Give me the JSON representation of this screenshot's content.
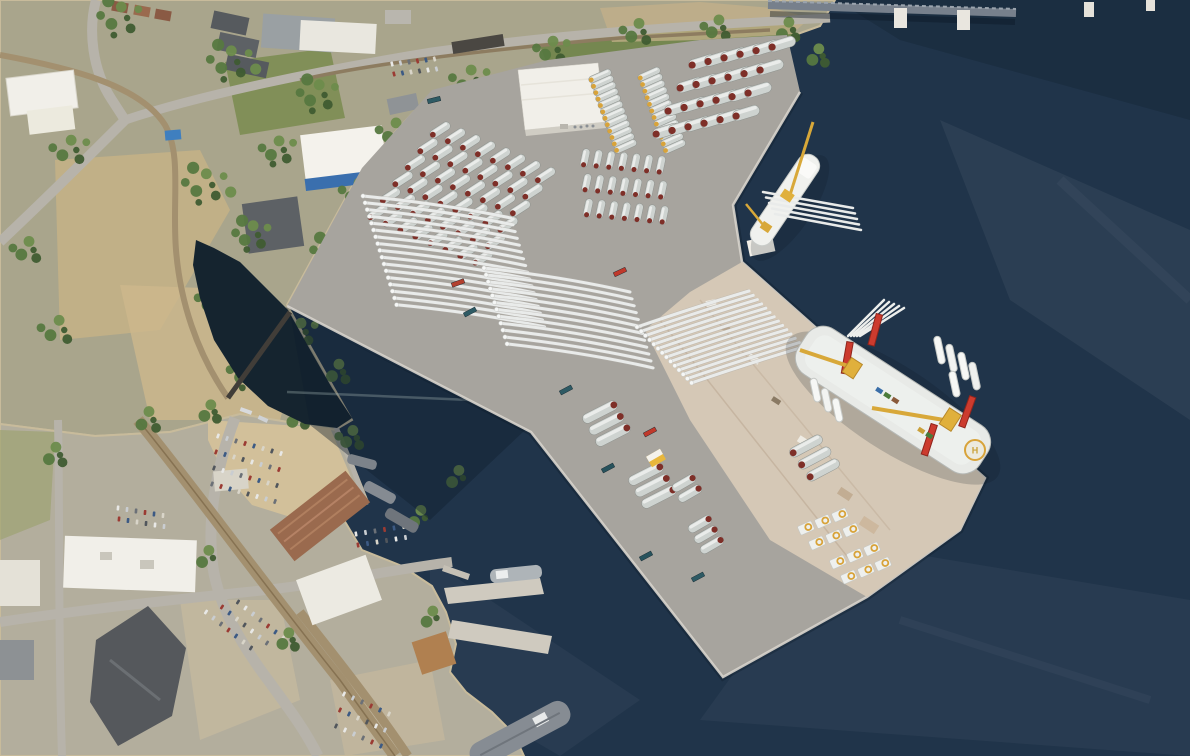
{
  "scene": {
    "description": "Aerial rendering of an offshore wind marshaling port: gray laydown terminal with stored turbine blades, tower sections, monopiles and nacelles, a blade transport ship and a jack-up installation vessel at the quay, surrounded by harbor water and an urban waterfront"
  },
  "labels": {
    "helipad": "H"
  },
  "colors": {
    "water": "#20344a",
    "water_deep": "#15242f",
    "pad": "#a7a49e",
    "pad_line": "#d8d4cc",
    "pier": "#d5c8b6",
    "land": "#a9a58c",
    "land_low": "#b3ae9d",
    "road": "#b7b3aa",
    "rail": "#a3906f",
    "building_white": "#f1efe9",
    "roof_dark": "#565a5e",
    "roof_rust": "#9a6a4e",
    "roof_blue": "#3a6fae",
    "blade": "#e9ebea",
    "tower_body": "#ced3d0",
    "tower_red": "#7e2f28",
    "flange_yellow": "#d8a33a",
    "crane_yellow": "#e0b03c",
    "leg_red": "#cc3b2e",
    "ship_white": "#f0f1ee",
    "nacelle": "#eef0ee",
    "concrete": "#cfcabf",
    "boat_gray": "#868c93",
    "shadow": "#0a1624",
    "tree_palette": [
      "#3f5c32",
      "#567840",
      "#6d8c4c"
    ],
    "car_palette": [
      "#e8e8e6",
      "#c9cdd1",
      "#6b7077",
      "#9b3b33",
      "#3c5a84",
      "#d9d5c9",
      "#51565c"
    ]
  },
  "inventory": {
    "tower_sections_flanged_columns": 24,
    "tower_sections_large_grid": 24,
    "tower_section_rows_west": 48,
    "tower_sections_center_grid": 21,
    "monopile_sections": 14,
    "nacelles": 12,
    "blades_west_array": 17,
    "blades_center_array": 12,
    "blades_pier_array": 14,
    "blades_on_transport_ship": 5,
    "blades_on_installation_vessel": 5,
    "installation_vessel_jackup_legs": 4,
    "installation_vessel_cranes": 2,
    "vessels": {
      "heavy_lift_installation_vessel": 1,
      "blade_transport_ship": 1,
      "harbor_craft": 6
    }
  },
  "gen": {
    "towers": [
      {
        "name": "tower-column-a",
        "x": 600,
        "y": 76,
        "rows": 12,
        "cols": 1,
        "rdx": 2.3,
        "rdy": 6.4,
        "cdx": 0,
        "cdy": 0,
        "len": 24,
        "wid": 7,
        "angle": -24,
        "cap": "flange_yellow"
      },
      {
        "name": "tower-column-b",
        "x": 649,
        "y": 74,
        "rows": 12,
        "cols": 1,
        "rdx": 2.3,
        "rdy": 6.6,
        "cdx": 0,
        "cdy": 0,
        "len": 24,
        "wid": 7,
        "angle": -24,
        "cap": "flange_yellow"
      },
      {
        "name": "tower-grid-northeast",
        "x": 702,
        "y": 62,
        "rows": 4,
        "cols": 6,
        "rdx": -12,
        "rdy": 23,
        "cdx": 16,
        "cdy": -3.6,
        "len": 28,
        "wid": 10.5,
        "angle": -17,
        "cap": "tower_red"
      },
      {
        "name": "tower-rows-center-west",
        "x": 440,
        "y": 130,
        "rows": 6,
        "cols": 8,
        "rdx": -12.5,
        "rdy": 16.5,
        "cdx": 15,
        "cdy": 6.5,
        "len": 23,
        "wid": 8.5,
        "angle": -33,
        "cap": "tower_red"
      },
      {
        "name": "tower-grid-center",
        "x": 585,
        "y": 158,
        "rows": 3,
        "cols": 7,
        "rdx": 1.5,
        "rdy": 25,
        "cdx": 12.6,
        "cdy": 1.2,
        "len": 19,
        "wid": 7.5,
        "angle": -78,
        "cap": "tower_red"
      }
    ],
    "blade_arrays": [
      {
        "name": "blade-array-west",
        "x": 363,
        "y": 196,
        "count": 17,
        "dx": 2.1,
        "dy": 6.8,
        "tdx": 148,
        "tdy": 22
      },
      {
        "name": "blade-array-center",
        "x": 484,
        "y": 268,
        "count": 12,
        "dx": 2.1,
        "dy": 6.9,
        "tdx": 146,
        "tdy": 24
      },
      {
        "name": "blade-array-pier",
        "x": 637,
        "y": 327,
        "count": 14,
        "dx": 4.2,
        "dy": 4.3,
        "tdx": 112,
        "tdy": -36
      }
    ],
    "monopiles": [
      {
        "x": 600,
        "y": 412,
        "n": 3,
        "dx": 6.5,
        "dy": 11.5,
        "len": 38,
        "wid": 10,
        "angle": -27,
        "capEnd": "e"
      },
      {
        "x": 646,
        "y": 474,
        "n": 3,
        "dx": 6.5,
        "dy": 11.5,
        "len": 38,
        "wid": 10,
        "angle": -27,
        "capEnd": "e"
      },
      {
        "x": 684,
        "y": 483,
        "n": 2,
        "dx": 6,
        "dy": 10.5,
        "len": 26,
        "wid": 9,
        "angle": -30,
        "capEnd": "e"
      },
      {
        "x": 700,
        "y": 524,
        "n": 3,
        "dx": 6,
        "dy": 10.5,
        "len": 26,
        "wid": 9,
        "angle": -30,
        "capEnd": "e"
      },
      {
        "x": 806,
        "y": 446,
        "n": 3,
        "dx": 8.5,
        "dy": 12,
        "len": 36,
        "wid": 10,
        "angle": -28,
        "capEnd": "w"
      }
    ],
    "nacelles": [
      {
        "x": 806,
        "y": 528,
        "rows": 2,
        "cols": 3
      },
      {
        "x": 838,
        "y": 562,
        "rows": 2,
        "cols": 3
      }
    ],
    "containers": [
      {
        "x": 470,
        "y": 312,
        "a": -28,
        "color": "#2e5a64"
      },
      {
        "x": 566,
        "y": 390,
        "a": -28,
        "color": "#2e5a64"
      },
      {
        "x": 608,
        "y": 468,
        "a": -28,
        "color": "#27525c"
      },
      {
        "x": 646,
        "y": 556,
        "a": -28,
        "color": "#27525c"
      },
      {
        "x": 698,
        "y": 577,
        "a": -28,
        "color": "#2e5a64"
      },
      {
        "x": 434,
        "y": 100,
        "a": -14,
        "color": "#2e5a64"
      },
      {
        "x": 650,
        "y": 432,
        "a": -28,
        "color": "#c0392b"
      },
      {
        "x": 458,
        "y": 283,
        "a": -20,
        "color": "#b3402e"
      },
      {
        "x": 620,
        "y": 272,
        "a": -25,
        "color": "#c0392b"
      }
    ],
    "car_lots": [
      {
        "x": 218,
        "y": 436,
        "rows": 4,
        "cols": 8,
        "cdx": 9,
        "cdy": 2.5,
        "rdx": -2,
        "rdy": 16,
        "a": -70
      },
      {
        "x": 206,
        "y": 612,
        "rows": 3,
        "cols": 7,
        "cdx": 7.5,
        "cdy": 6,
        "rdx": 16,
        "rdy": -5,
        "a": -58
      },
      {
        "x": 344,
        "y": 694,
        "rows": 3,
        "cols": 6,
        "cdx": 9,
        "cdy": 4,
        "rdx": -4,
        "rdy": 16,
        "a": -65
      },
      {
        "x": 118,
        "y": 508,
        "rows": 2,
        "cols": 6,
        "cdx": 9,
        "cdy": 1.5,
        "rdx": 1,
        "rdy": 11,
        "a": -85
      },
      {
        "x": 356,
        "y": 534,
        "rows": 2,
        "cols": 6,
        "cdx": 9.5,
        "cdy": -1.5,
        "rdx": 2,
        "rdy": 11,
        "a": 80
      },
      {
        "x": 392,
        "y": 64,
        "rows": 2,
        "cols": 6,
        "cdx": 8.5,
        "cdy": -1,
        "rdx": 2,
        "rdy": 10,
        "a": 75
      }
    ],
    "tree_clusters": [
      [
        120,
        18,
        26,
        8
      ],
      [
        230,
        62,
        28,
        9
      ],
      [
        318,
        95,
        24,
        8
      ],
      [
        70,
        150,
        20,
        6
      ],
      [
        205,
        185,
        28,
        9
      ],
      [
        278,
        150,
        20,
        7
      ],
      [
        252,
        235,
        22,
        8
      ],
      [
        215,
        300,
        24,
        9
      ],
      [
        248,
        372,
        24,
        8
      ],
      [
        300,
        332,
        18,
        6
      ],
      [
        330,
        252,
        22,
        8
      ],
      [
        358,
        192,
        20,
        7
      ],
      [
        395,
        132,
        20,
        7
      ],
      [
        470,
        80,
        22,
        7
      ],
      [
        552,
        50,
        18,
        6
      ],
      [
        638,
        32,
        16,
        5
      ],
      [
        718,
        28,
        15,
        5
      ],
      [
        788,
        30,
        13,
        4
      ],
      [
        818,
        56,
        12,
        4
      ],
      [
        352,
        438,
        14,
        5
      ],
      [
        385,
        300,
        15,
        5
      ],
      [
        58,
        330,
        18,
        5
      ],
      [
        28,
        250,
        16,
        5
      ],
      [
        148,
        420,
        14,
        4
      ],
      [
        55,
        455,
        13,
        4
      ],
      [
        208,
        558,
        11,
        3
      ],
      [
        288,
        640,
        12,
        4
      ],
      [
        420,
        518,
        11,
        3
      ],
      [
        458,
        478,
        11,
        3
      ],
      [
        298,
        418,
        12,
        4
      ],
      [
        432,
        618,
        10,
        3
      ],
      [
        338,
        372,
        13,
        4
      ],
      [
        210,
        412,
        12,
        4
      ]
    ]
  }
}
